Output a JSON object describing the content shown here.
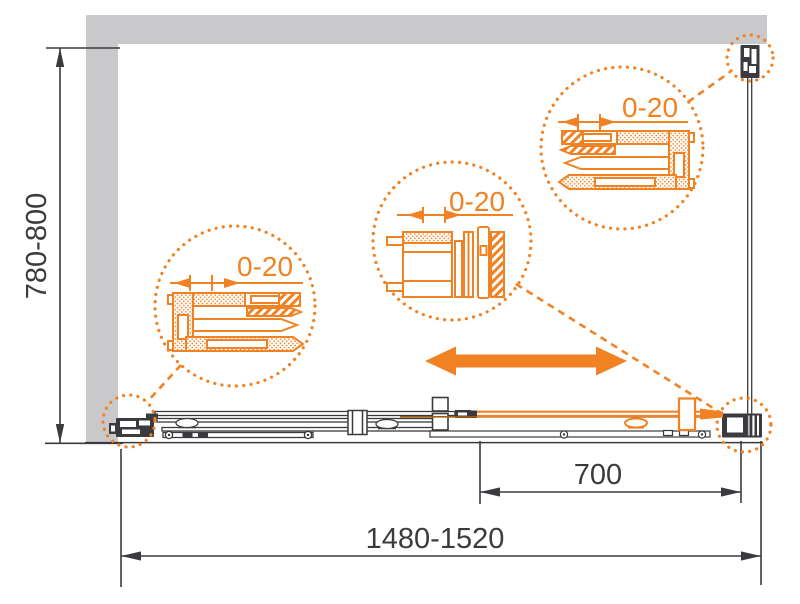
{
  "dimensions": {
    "height_range": "780-800",
    "total_width_range": "1480-1520",
    "door_panel_width": "700"
  },
  "callouts": {
    "left_wall_profile_adjustment": "0-20",
    "right_wall_profile_adjustment": "0-20",
    "top_bracket_adjustment": "0-20"
  },
  "icons": {
    "slide_direction_arrow": "double-headed-horizontal-arrow"
  },
  "colors": {
    "accent_orange": "#F08223",
    "wall_gray": "#C9C9CB",
    "line_dark": "#3B3B3F"
  }
}
